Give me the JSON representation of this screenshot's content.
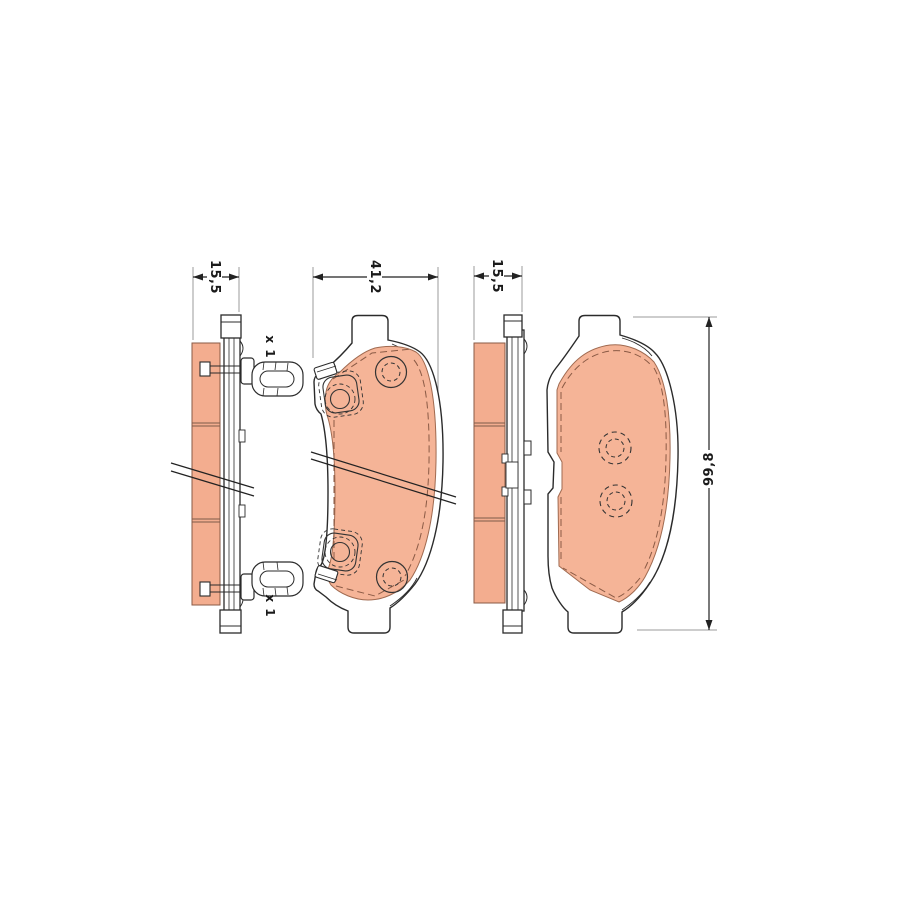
{
  "drawing": {
    "views": [
      {
        "name": "pad-side-view-with-clips",
        "dimension_label": "15,5",
        "accessory_labels": [
          "x 1",
          "x 1"
        ]
      },
      {
        "name": "pad-front-view-inner",
        "dimension_label": "41,2"
      },
      {
        "name": "pad-side-view-plain",
        "dimension_label": "15,5"
      },
      {
        "name": "pad-front-view-outer",
        "dimension_label": "99,8"
      }
    ],
    "colors": {
      "background": "#ffffff",
      "friction_front": "#f5b497",
      "friction_side": "#f3ad8f",
      "outline": "#2b2b2b",
      "chamfer_dash": "#8a5a45",
      "division_line": "#7d5b49",
      "extension_line": "#9b9b9b",
      "dimension_line": "#222222"
    }
  }
}
